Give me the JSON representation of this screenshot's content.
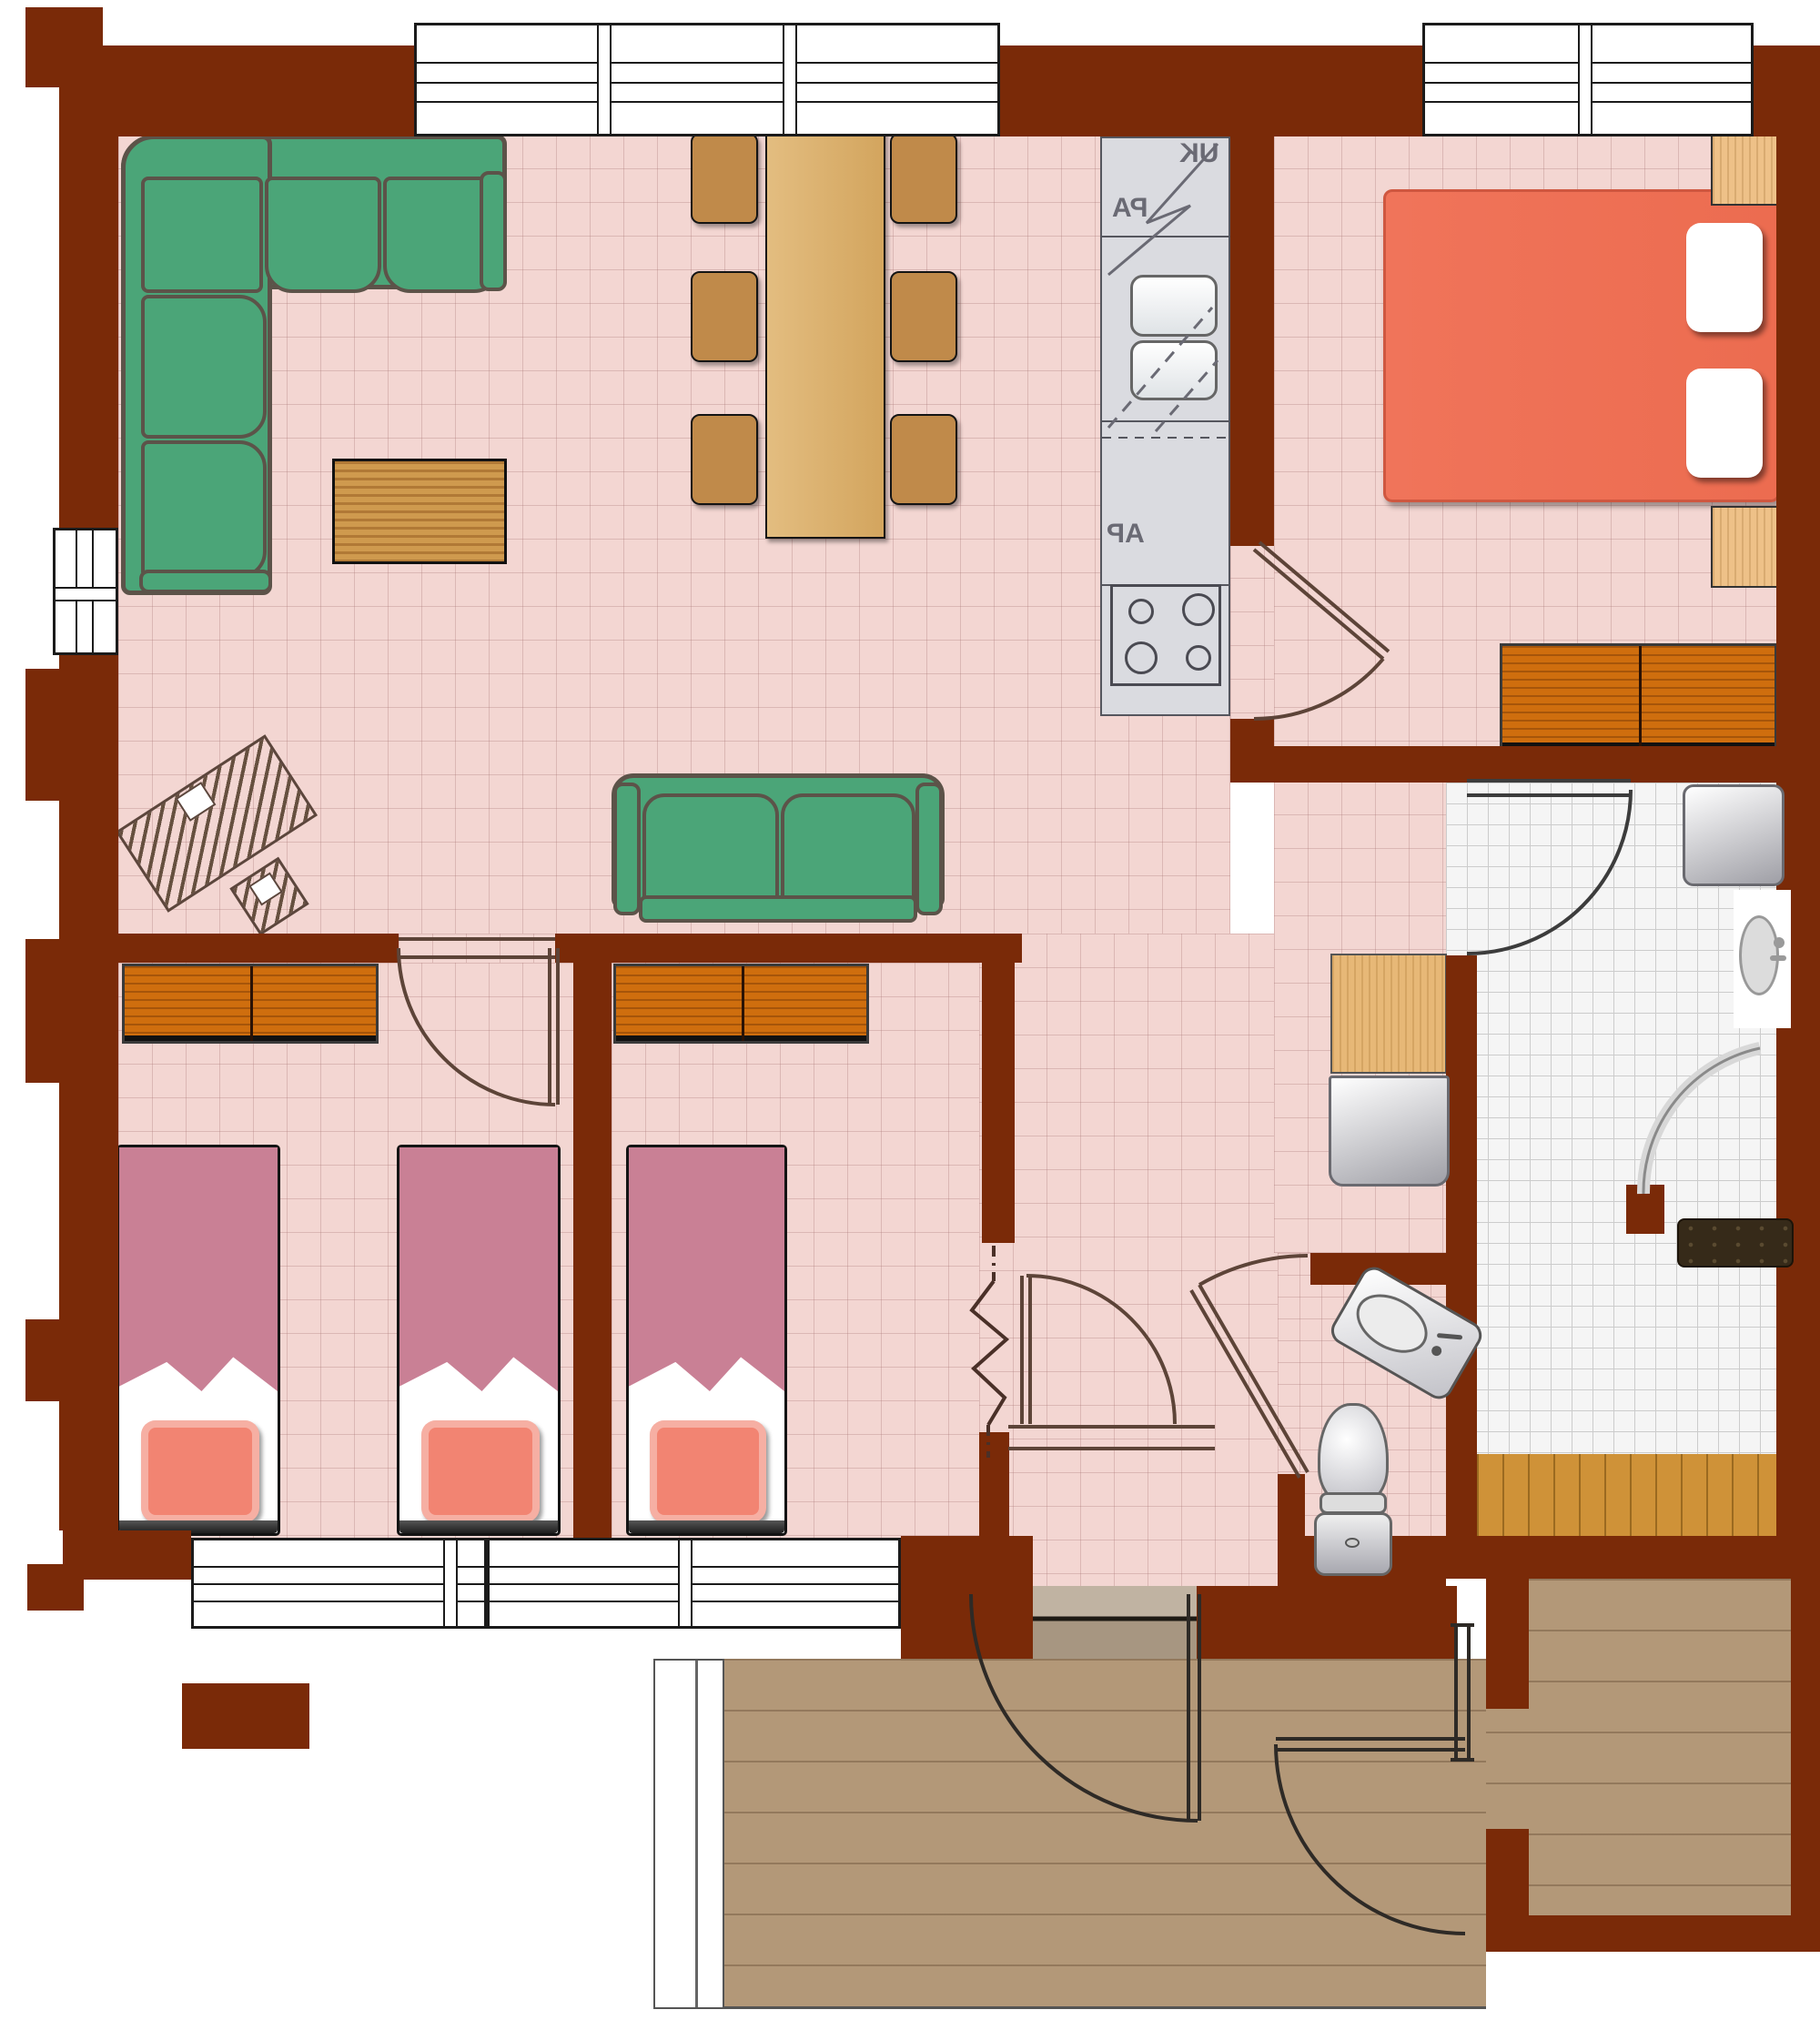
{
  "plan": {
    "type": "apartment-floor-plan",
    "view": "top-down",
    "rooms": [
      {
        "name": "living-dining-room",
        "floor": "pink-tile"
      },
      {
        "name": "kitchen-strip",
        "floor": "pink-tile"
      },
      {
        "name": "master-bedroom",
        "floor": "pink-tile"
      },
      {
        "name": "bedroom-two-beds",
        "floor": "pink-tile"
      },
      {
        "name": "bedroom-one-bed",
        "floor": "pink-tile"
      },
      {
        "name": "hallway",
        "floor": "pink-tile"
      },
      {
        "name": "wc",
        "floor": "pink-tile-small"
      },
      {
        "name": "bathroom",
        "floor": "white-tile"
      },
      {
        "name": "terrace-deck",
        "floor": "wood-plank"
      },
      {
        "name": "side-room",
        "floor": "wood-plank"
      }
    ],
    "furniture": [
      "corner-sofa",
      "coffee-table",
      "dining-table",
      "dining-chairs-x6",
      "two-seat-sofa",
      "sketched-desk-with-chair",
      "kitchen-counter",
      "kitchen-sink-double",
      "kitchen-stove-4-burners",
      "double-bed",
      "pillows-x2",
      "nightstands-x2",
      "wardrobe-master",
      "single-beds-x3",
      "wardrobes-x2",
      "hall-cabinet",
      "hall-appliance",
      "washing-machine",
      "wall-sink",
      "shower-swing",
      "bath-mat",
      "wood-bench-strip",
      "toilet",
      "corner-sink",
      "door-arcs-x8",
      "windows-x5",
      "entry-threshold"
    ]
  },
  "kitchen": {
    "label_upper": "UK",
    "label_mid": "PA",
    "label_lower": "AP"
  },
  "colors": {
    "wall": "#7a2a08",
    "floor": "#f3d6d2",
    "floorline": "rgba(170,118,118,0.33)",
    "tile": "#f5f5f5",
    "tileline": "#cccccc",
    "deck": "#b39878",
    "deckline": "rgba(86,62,40,0.35)",
    "bench": "#cf9238",
    "benchline": "rgba(104,66,8,0.5)",
    "sofa": "#4ba578",
    "sofaline": "#5c5349",
    "chair": "#c08a4a",
    "table": "#ddb476",
    "coffee": "#cf9a4e",
    "dresser": "#cf6e0e",
    "blanket": "#c98095",
    "pillow": "#f28472",
    "mbed": "#f07258",
    "nstand": "#eec188",
    "counter": "#dadbe0",
    "klabel": "#6a6a74",
    "arc": "#5d4438",
    "mat": "#362a19"
  }
}
